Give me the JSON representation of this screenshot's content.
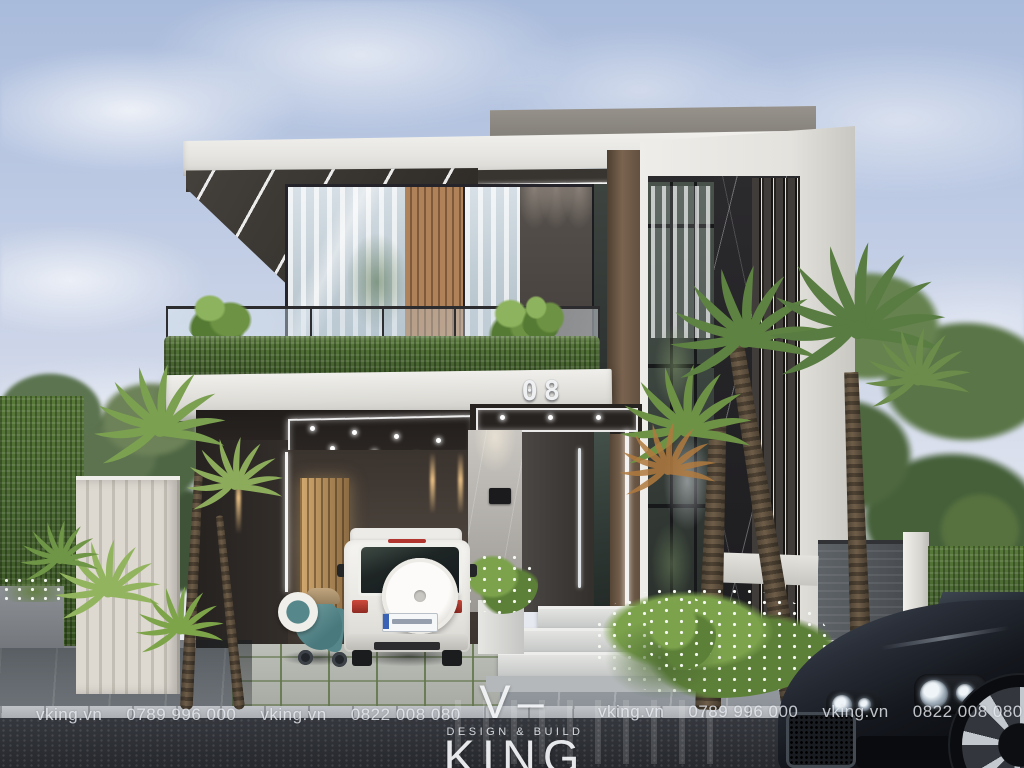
{
  "branding": {
    "logo": "V–KING",
    "tagline": "DESIGN & BUILD"
  },
  "watermarks": {
    "left": {
      "site_a": "vking.vn",
      "phone_a": "0789 996 000",
      "site_b": "vking.vn",
      "phone_b": "0822 008 080"
    },
    "right": {
      "site_a": "vking.vn",
      "phone_a": "0789 996 000",
      "site_b": "vking.vn",
      "phone_b": "0822 008 080"
    }
  },
  "house": {
    "number": "08"
  },
  "palette": {
    "sky_top": "#a9bbdb",
    "sky_horizon": "#e7e9f0",
    "stone_white": "#e9e8e3",
    "charcoal_wall": "#46413d",
    "wood_slat": "#a87a50",
    "bronze_frame": "#6b5846",
    "black_marble": "#232225",
    "hedge_green": "#46632f",
    "palm_green": "#739a4a",
    "led_white": "#ffffff",
    "warm_light": "#e8b97a",
    "suv_white": "#f0efec",
    "car_black": "#111318",
    "scooter_teal": "#5f9094",
    "road_dark": "#2e3138",
    "sidewalk_gray": "#9aa0a7"
  }
}
